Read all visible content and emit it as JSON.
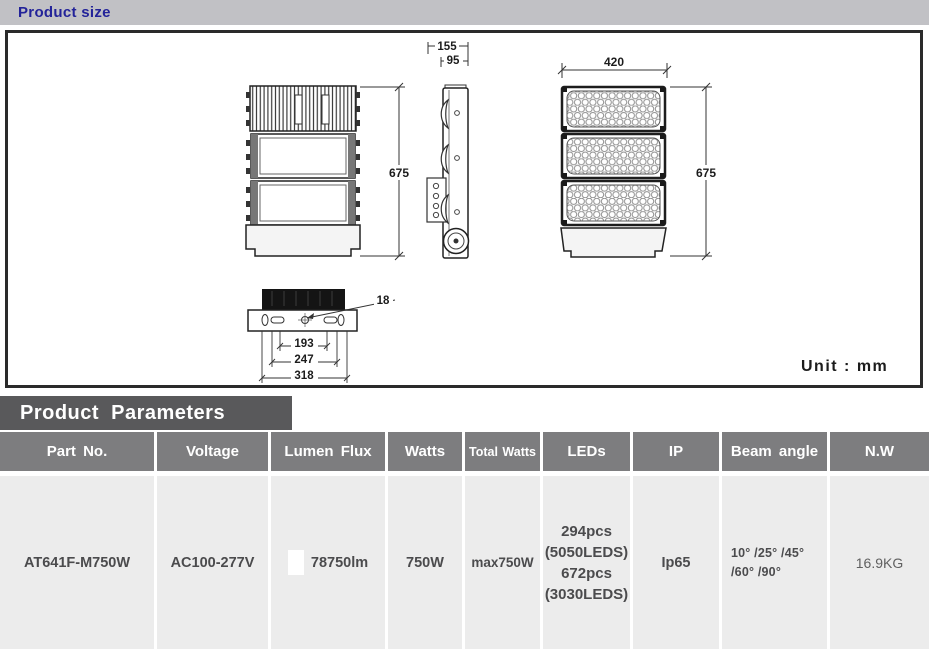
{
  "header": {
    "title": "Product size"
  },
  "drawing": {
    "unit_label": "Unit : mm",
    "dimensions": {
      "side_overall_width": "155",
      "side_body_width": "95",
      "front_width": "420",
      "rear_height": "675",
      "front_height": "675",
      "hole_diameter": "18",
      "mount_span_inner": "193",
      "mount_span_middle": "247",
      "mount_span_outer": "318"
    }
  },
  "parameters": {
    "title": "Product Parameters",
    "columns": [
      "Part No.",
      "Voltage",
      "Lumen Flux",
      "Watts",
      "Total Watts",
      "LEDs",
      "IP",
      "Beam angle",
      "N.W"
    ],
    "row": {
      "part_no": "AT641F-M750W",
      "voltage": "AC100-277V",
      "lumen_flux": "78750lm",
      "watts": "750W",
      "total_watts": "max750W",
      "leds_lines": [
        "294pcs",
        "(5050LEDS)",
        "672pcs",
        "(3030LEDS)"
      ],
      "ip": "Ip65",
      "beam_angle_lines": [
        "10° /25° /45°",
        "/60° /90°"
      ],
      "net_weight": "16.9KG"
    }
  }
}
